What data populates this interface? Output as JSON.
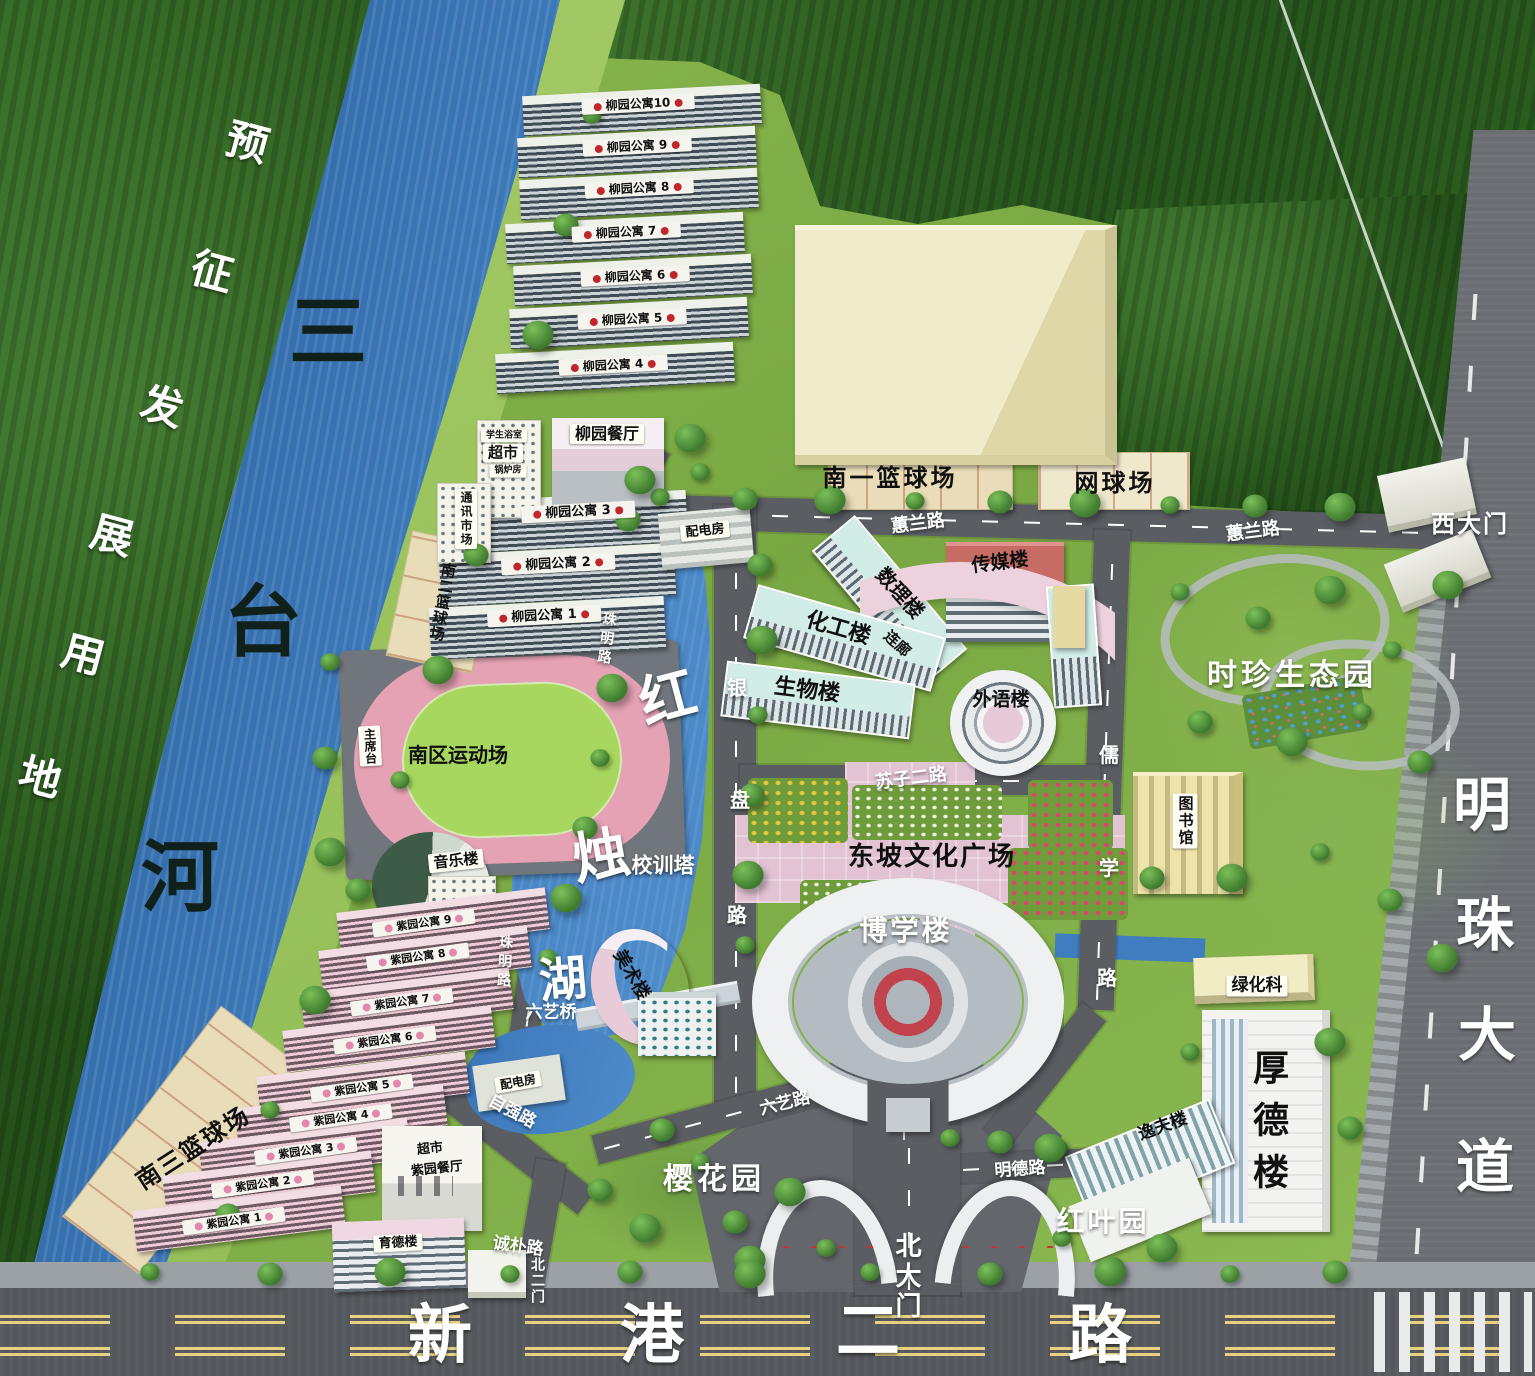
{
  "map": {
    "type": "campus-master-plan",
    "accent_colors": {
      "water": "#4584c4",
      "forest": "#2c5e20",
      "grass": "#85b34c",
      "road": "#5a5e63",
      "plaza_pink": "#e2c3d4",
      "court_cream": "#e9ddb9"
    }
  },
  "labels": [
    {
      "n": "label-liuyuan-apt-10",
      "t": "柳园公寓10",
      "x": 638,
      "y": 104,
      "fs": 12,
      "c": "bar",
      "r": -3
    },
    {
      "n": "label-liuyuan-apt-9",
      "t": "柳园公寓 9",
      "x": 637,
      "y": 146,
      "fs": 12,
      "c": "bar",
      "r": -3
    },
    {
      "n": "label-liuyuan-apt-8",
      "t": "柳园公寓 8",
      "x": 639,
      "y": 188,
      "fs": 12,
      "c": "bar",
      "r": -3
    },
    {
      "n": "label-liuyuan-apt-7",
      "t": "柳园公寓 7",
      "x": 626,
      "y": 232,
      "fs": 12,
      "c": "bar",
      "r": -3
    },
    {
      "n": "label-liuyuan-apt-6",
      "t": "柳园公寓 6",
      "x": 635,
      "y": 276,
      "fs": 12,
      "c": "bar",
      "r": -3
    },
    {
      "n": "label-liuyuan-apt-5",
      "t": "柳园公寓 5",
      "x": 632,
      "y": 319,
      "fs": 12,
      "c": "bar",
      "r": -3
    },
    {
      "n": "label-liuyuan-apt-4",
      "t": "柳园公寓 4",
      "x": 613,
      "y": 365,
      "fs": 12,
      "c": "bar",
      "r": -3
    },
    {
      "n": "label-liuyuan-apt-3",
      "t": "柳园公寓 3",
      "x": 578,
      "y": 512,
      "fs": 13,
      "c": "bar",
      "r": -3
    },
    {
      "n": "label-liuyuan-apt-2",
      "t": "柳园公寓 2",
      "x": 558,
      "y": 564,
      "fs": 13,
      "c": "bar",
      "r": -3
    },
    {
      "n": "label-liuyuan-apt-1",
      "t": "柳园公寓 1",
      "x": 544,
      "y": 616,
      "fs": 13,
      "c": "bar",
      "r": -3
    },
    {
      "n": "label-ziyuan-apt-9",
      "t": "紫园公寓 9",
      "x": 424,
      "y": 923,
      "fs": 11,
      "c": "bar barp",
      "r": -8
    },
    {
      "n": "label-ziyuan-apt-8",
      "t": "紫园公寓 8",
      "x": 418,
      "y": 957,
      "fs": 11,
      "c": "bar barp",
      "r": -8
    },
    {
      "n": "label-ziyuan-apt-7",
      "t": "紫园公寓 7",
      "x": 402,
      "y": 1002,
      "fs": 11,
      "c": "bar barp",
      "r": -8
    },
    {
      "n": "label-ziyuan-apt-6",
      "t": "紫园公寓 6",
      "x": 385,
      "y": 1040,
      "fs": 11,
      "c": "bar barp",
      "r": -8
    },
    {
      "n": "label-ziyuan-apt-5",
      "t": "紫园公寓 5",
      "x": 362,
      "y": 1088,
      "fs": 11,
      "c": "bar barp",
      "r": -8
    },
    {
      "n": "label-ziyuan-apt-4",
      "t": "紫园公寓 4",
      "x": 341,
      "y": 1118,
      "fs": 11,
      "c": "bar barp",
      "r": -8
    },
    {
      "n": "label-ziyuan-apt-3",
      "t": "紫园公寓 3",
      "x": 306,
      "y": 1151,
      "fs": 11,
      "c": "bar barp",
      "r": -8
    },
    {
      "n": "label-ziyuan-apt-2",
      "t": "紫园公寓 2",
      "x": 263,
      "y": 1184,
      "fs": 11,
      "c": "bar barp",
      "r": -8
    },
    {
      "n": "label-ziyuan-apt-1",
      "t": "紫园公寓 1",
      "x": 234,
      "y": 1221,
      "fs": 11,
      "c": "bar barp",
      "r": -8
    },
    {
      "n": "label-liuyuan-canteen",
      "t": "柳园餐厅",
      "x": 607,
      "y": 434,
      "fs": 16,
      "c": "box"
    },
    {
      "n": "label-student-bath",
      "t": "学生浴室",
      "x": 504,
      "y": 436,
      "fs": 9,
      "c": "box"
    },
    {
      "n": "label-supermarket-north",
      "t": "超市",
      "x": 503,
      "y": 453,
      "fs": 15,
      "c": "box"
    },
    {
      "n": "label-boiler-room",
      "t": "锅炉房",
      "x": 508,
      "y": 471,
      "fs": 9,
      "c": "box"
    },
    {
      "n": "label-comm-market",
      "t": "通讯市场",
      "x": 466,
      "y": 519,
      "fs": 12,
      "c": "box v",
      "ls": 2
    },
    {
      "n": "label-power-room-north",
      "t": "配电房",
      "x": 705,
      "y": 531,
      "fs": 13,
      "c": "box",
      "r": -6
    },
    {
      "n": "label-power-room-south",
      "t": "配电房",
      "x": 518,
      "y": 1082,
      "fs": 12,
      "c": "box",
      "r": -10
    },
    {
      "n": "label-rostrum",
      "t": "主席台",
      "x": 370,
      "y": 746,
      "fs": 12,
      "c": "box v",
      "r": -3
    },
    {
      "n": "label-music-building",
      "t": "音乐楼",
      "x": 456,
      "y": 861,
      "fs": 15,
      "c": "box",
      "r": -6
    },
    {
      "n": "label-library",
      "t": "图书馆",
      "x": 1185,
      "y": 821,
      "fs": 15,
      "c": "box v",
      "ls": 2
    },
    {
      "n": "label-greening-office",
      "t": "绿化科",
      "x": 1257,
      "y": 986,
      "fs": 17,
      "c": "box"
    },
    {
      "n": "label-yude-building",
      "t": "育德楼",
      "x": 398,
      "y": 1243,
      "fs": 13,
      "c": "box",
      "r": -3
    },
    {
      "n": "label-south2-basketball",
      "t": "南二篮球场",
      "x": 442,
      "y": 602,
      "fs": 15,
      "c": "blk v",
      "r": 10,
      "ls": 1
    },
    {
      "n": "label-south1-basketball",
      "t": "南一篮球场",
      "x": 890,
      "y": 478,
      "fs": 24,
      "c": "blk",
      "ls": 3
    },
    {
      "n": "label-tennis-court",
      "t": "网球场",
      "x": 1115,
      "y": 483,
      "fs": 24,
      "c": "blk",
      "ls": 3
    },
    {
      "n": "label-shuli-building",
      "t": "数理楼",
      "x": 900,
      "y": 593,
      "fs": 20,
      "c": "blk",
      "r": 48
    },
    {
      "n": "label-chuanmei-building",
      "t": "传媒楼",
      "x": 1000,
      "y": 563,
      "fs": 19,
      "c": "blk",
      "r": -7
    },
    {
      "n": "label-huagong-building",
      "t": "化工楼",
      "x": 838,
      "y": 629,
      "fs": 22,
      "c": "blk",
      "r": 16
    },
    {
      "n": "label-shengwu-building",
      "t": "生物楼",
      "x": 807,
      "y": 691,
      "fs": 22,
      "c": "blk",
      "r": 7
    },
    {
      "n": "label-lianlang",
      "t": "连廊",
      "x": 897,
      "y": 644,
      "fs": 15,
      "c": "blk",
      "r": 42
    },
    {
      "n": "label-waiyu-building",
      "t": "外语楼",
      "x": 1001,
      "y": 700,
      "fs": 19,
      "c": "blk"
    },
    {
      "n": "label-dongpo-plaza",
      "t": "东坡文化广场",
      "x": 932,
      "y": 857,
      "fs": 26,
      "c": "blk",
      "ls": 2
    },
    {
      "n": "label-south-sports-field",
      "t": "南区运动场",
      "x": 458,
      "y": 755,
      "fs": 20,
      "c": "blk"
    },
    {
      "n": "label-south3-basketball",
      "t": "南三篮球场",
      "x": 193,
      "y": 1148,
      "fs": 24,
      "c": "blk",
      "r": -33,
      "ls": 2
    },
    {
      "n": "label-supermarket-south",
      "t": "超市",
      "x": 430,
      "y": 1149,
      "fs": 13,
      "c": "blk",
      "r": -6
    },
    {
      "n": "label-ziyuan-canteen",
      "t": "紫园餐厅",
      "x": 437,
      "y": 1169,
      "fs": 13,
      "c": "blk",
      "r": -6
    },
    {
      "n": "label-meishu-building",
      "t": "美术楼",
      "x": 631,
      "y": 975,
      "fs": 18,
      "c": "blk",
      "r": 60
    },
    {
      "n": "label-houde-building",
      "t": "厚德楼",
      "x": 1267,
      "y": 1127,
      "fs": 36,
      "c": "blk v",
      "ls": 16
    },
    {
      "n": "label-yifu-building",
      "t": "逸夫楼",
      "x": 1163,
      "y": 1127,
      "fs": 17,
      "c": "blk",
      "r": -20
    },
    {
      "n": "label-river-char-1",
      "t": "三",
      "x": 328,
      "y": 333,
      "fs": 78,
      "c": "rvr"
    },
    {
      "n": "label-river-char-2",
      "t": "台",
      "x": 263,
      "y": 623,
      "fs": 78,
      "c": "rvr"
    },
    {
      "n": "label-river-char-3",
      "t": "河",
      "x": 180,
      "y": 878,
      "fs": 78,
      "c": "rvr"
    },
    {
      "n": "label-huilan-road-1",
      "t": "蕙兰路",
      "x": 918,
      "y": 524,
      "fs": 18,
      "c": "wht",
      "r": -7
    },
    {
      "n": "label-huilan-road-2",
      "t": "蕙兰路",
      "x": 1253,
      "y": 532,
      "fs": 18,
      "c": "wht",
      "r": -7
    },
    {
      "n": "label-west-gate",
      "t": "西大门",
      "x": 1470,
      "y": 524,
      "fs": 24,
      "c": "wht",
      "ls": 2
    },
    {
      "n": "label-shizhen-eco-garden",
      "t": "时珍生态园",
      "x": 1292,
      "y": 676,
      "fs": 30,
      "c": "wht",
      "ls": 4
    },
    {
      "n": "label-suzi-2-road",
      "t": "苏子二路",
      "x": 911,
      "y": 779,
      "fs": 18,
      "c": "wht",
      "r": -7
    },
    {
      "n": "label-ruxue-road-char-1",
      "t": "儒",
      "x": 1109,
      "y": 755,
      "fs": 20,
      "c": "wht"
    },
    {
      "n": "label-ruxue-road-char-2",
      "t": "学",
      "x": 1109,
      "y": 868,
      "fs": 20,
      "c": "wht"
    },
    {
      "n": "label-ruxue-road-char-3",
      "t": "路",
      "x": 1107,
      "y": 978,
      "fs": 20,
      "c": "wht"
    },
    {
      "n": "label-yinpan-road-char-1",
      "t": "银",
      "x": 737,
      "y": 688,
      "fs": 20,
      "c": "wht"
    },
    {
      "n": "label-yinpan-road-char-2",
      "t": "盘",
      "x": 740,
      "y": 800,
      "fs": 20,
      "c": "wht"
    },
    {
      "n": "label-yinpan-road-char-3",
      "t": "路",
      "x": 737,
      "y": 915,
      "fs": 20,
      "c": "wht"
    },
    {
      "n": "label-zhuming-road-1",
      "t": "珠明路",
      "x": 606,
      "y": 640,
      "fs": 14,
      "c": "wht v",
      "r": 8,
      "ls": 5
    },
    {
      "n": "label-zhuming-road-2",
      "t": "珠明路",
      "x": 504,
      "y": 963,
      "fs": 14,
      "c": "wht v",
      "r": 3,
      "ls": 5
    },
    {
      "n": "label-boxue-building",
      "t": "博学楼",
      "x": 906,
      "y": 931,
      "fs": 28,
      "c": "wht",
      "ls": 3
    },
    {
      "n": "label-xiaoxun-tower",
      "t": "校训塔",
      "x": 663,
      "y": 866,
      "fs": 21,
      "c": "wht"
    },
    {
      "n": "label-lake-char-1",
      "t": "红",
      "x": 668,
      "y": 699,
      "fs": 56,
      "c": "wht",
      "r": -15
    },
    {
      "n": "label-lake-char-2",
      "t": "烛",
      "x": 601,
      "y": 857,
      "fs": 56,
      "c": "wht",
      "r": -10
    },
    {
      "n": "label-lake-char-3",
      "t": "湖",
      "x": 563,
      "y": 980,
      "fs": 48,
      "c": "wht",
      "r": -5
    },
    {
      "n": "label-liuyi-bridge",
      "t": "六艺桥",
      "x": 551,
      "y": 1013,
      "fs": 17,
      "c": "wht"
    },
    {
      "n": "label-liuyi-road",
      "t": "六艺路",
      "x": 785,
      "y": 1104,
      "fs": 17,
      "c": "wht",
      "r": -14
    },
    {
      "n": "label-sakura-garden",
      "t": "樱花园",
      "x": 714,
      "y": 1180,
      "fs": 30,
      "c": "wht",
      "ls": 4
    },
    {
      "n": "label-ziqiang-road",
      "t": "自强路",
      "x": 512,
      "y": 1112,
      "fs": 17,
      "c": "wht",
      "r": 28
    },
    {
      "n": "label-chengpu-road",
      "t": "诚朴路",
      "x": 518,
      "y": 1247,
      "fs": 17,
      "c": "wht",
      "r": 8
    },
    {
      "n": "label-north-gate-2",
      "t": "北二门",
      "x": 537,
      "y": 1281,
      "fs": 14,
      "c": "wht v",
      "ls": 2
    },
    {
      "n": "label-mingde-road",
      "t": "明德路",
      "x": 1020,
      "y": 1170,
      "fs": 17,
      "c": "wht",
      "r": -4
    },
    {
      "n": "label-hongye-garden",
      "t": "红叶园",
      "x": 1103,
      "y": 1222,
      "fs": 28,
      "c": "wht",
      "ls": 3
    },
    {
      "n": "label-north-gate",
      "t": "北大门",
      "x": 906,
      "y": 1277,
      "fs": 26,
      "c": "wht v",
      "ls": 4
    },
    {
      "n": "label-mingzhu-ave-char-1",
      "t": "明",
      "x": 1482,
      "y": 805,
      "fs": 58,
      "c": "wht"
    },
    {
      "n": "label-mingzhu-ave-char-2",
      "t": "珠",
      "x": 1485,
      "y": 925,
      "fs": 58,
      "c": "wht"
    },
    {
      "n": "label-mingzhu-ave-char-3",
      "t": "大",
      "x": 1487,
      "y": 1035,
      "fs": 58,
      "c": "wht"
    },
    {
      "n": "label-mingzhu-ave-char-4",
      "t": "道",
      "x": 1485,
      "y": 1167,
      "fs": 58,
      "c": "wht"
    },
    {
      "n": "label-xingang-road-char-1",
      "t": "新",
      "x": 440,
      "y": 1336,
      "fs": 64,
      "c": "wht"
    },
    {
      "n": "label-xingang-road-char-2",
      "t": "港",
      "x": 652,
      "y": 1336,
      "fs": 64,
      "c": "wht"
    },
    {
      "n": "label-xingang-road-char-3",
      "t": "二",
      "x": 868,
      "y": 1332,
      "fs": 64,
      "c": "wht"
    },
    {
      "n": "label-xingang-road-char-4",
      "t": "路",
      "x": 1100,
      "y": 1336,
      "fs": 64,
      "c": "wht"
    },
    {
      "n": "label-reserved-land-char-1",
      "t": "预",
      "x": 247,
      "y": 143,
      "fs": 42,
      "c": "wht",
      "r": 15
    },
    {
      "n": "label-reserved-land-char-2",
      "t": "征",
      "x": 212,
      "y": 272,
      "fs": 42,
      "c": "wht",
      "r": 15
    },
    {
      "n": "label-reserved-land-char-3",
      "t": "发",
      "x": 162,
      "y": 407,
      "fs": 42,
      "c": "wht",
      "r": 15
    },
    {
      "n": "label-reserved-land-char-4",
      "t": "展",
      "x": 112,
      "y": 536,
      "fs": 42,
      "c": "wht",
      "r": 15
    },
    {
      "n": "label-reserved-land-char-5",
      "t": "用",
      "x": 83,
      "y": 655,
      "fs": 42,
      "c": "wht",
      "r": 15
    },
    {
      "n": "label-reserved-land-char-6",
      "t": "地",
      "x": 40,
      "y": 778,
      "fs": 42,
      "c": "wht",
      "r": 15
    }
  ]
}
